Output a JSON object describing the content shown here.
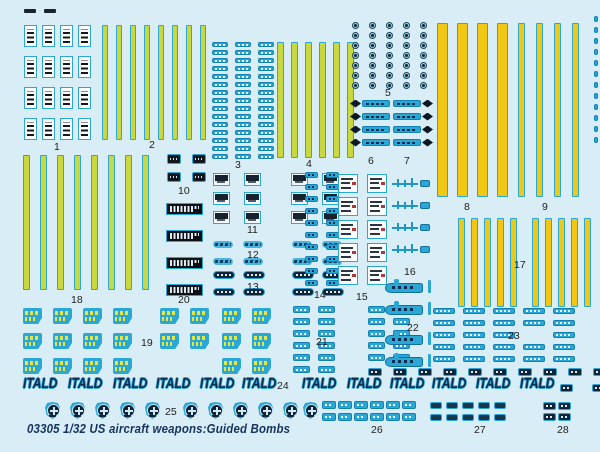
{
  "sheet": {
    "width": 600,
    "height": 452
  },
  "caption": {
    "text": "03305 1/32 US aircraft weapons:Guided Bombs",
    "color": "#14335e"
  },
  "palette": {
    "background": "#d9edf6",
    "teal": "#2ba7d6",
    "teal_dark": "#1181b4",
    "navy": "#0e2a4c",
    "black": "#10161c",
    "stripe_green": "#c9d83e",
    "stripe_gold": "#f0c713",
    "stencil_yellow": "#e9e53f",
    "red_mark": "#b33636",
    "white": "#ffffff"
  },
  "itald": {
    "text": "ITALD",
    "y": 375,
    "xs": [
      23,
      68,
      113,
      156,
      200,
      242,
      302,
      347,
      390,
      432,
      476,
      520
    ]
  },
  "roundels": {
    "y": 402,
    "w": 15,
    "h": 17,
    "xs": [
      45,
      70,
      95,
      120,
      145,
      183,
      208,
      233,
      258,
      283,
      303
    ]
  },
  "labels": [
    {
      "text": "1",
      "x": 54,
      "y": 141
    },
    {
      "text": "2",
      "x": 149,
      "y": 139
    },
    {
      "text": "3",
      "x": 235,
      "y": 159
    },
    {
      "text": "4",
      "x": 306,
      "y": 158
    },
    {
      "text": "5",
      "x": 385,
      "y": 87
    },
    {
      "text": "6",
      "x": 368,
      "y": 155
    },
    {
      "text": "7",
      "x": 404,
      "y": 155
    },
    {
      "text": "8",
      "x": 464,
      "y": 201
    },
    {
      "text": "9",
      "x": 542,
      "y": 201
    },
    {
      "text": "10",
      "x": 178,
      "y": 185
    },
    {
      "text": "11",
      "x": 247,
      "y": 224
    },
    {
      "text": "12",
      "x": 247,
      "y": 249
    },
    {
      "text": "13",
      "x": 247,
      "y": 281
    },
    {
      "text": "14",
      "x": 314,
      "y": 289
    },
    {
      "text": "15",
      "x": 356,
      "y": 291
    },
    {
      "text": "16",
      "x": 404,
      "y": 266
    },
    {
      "text": "17",
      "x": 514,
      "y": 259
    },
    {
      "text": "18",
      "x": 71,
      "y": 294
    },
    {
      "text": "19",
      "x": 141,
      "y": 337
    },
    {
      "text": "20",
      "x": 178,
      "y": 294
    },
    {
      "text": "21",
      "x": 316,
      "y": 336
    },
    {
      "text": "22",
      "x": 407,
      "y": 322
    },
    {
      "text": "23",
      "x": 508,
      "y": 330
    },
    {
      "text": "24",
      "x": 277,
      "y": 380
    },
    {
      "text": "25",
      "x": 165,
      "y": 406
    },
    {
      "text": "26",
      "x": 371,
      "y": 424
    },
    {
      "text": "27",
      "x": 474,
      "y": 424
    },
    {
      "text": "28",
      "x": 557,
      "y": 424
    }
  ],
  "groups": [
    {
      "name": "corner-fragments",
      "kind": "grid",
      "cls": "dash d-frag",
      "x": 24,
      "y": 9,
      "cols": 2,
      "rows": 1,
      "w": 12,
      "h": 4,
      "gx": 8,
      "gy": 0
    },
    {
      "name": "group-1-stencil-stamps",
      "kind": "grid",
      "cls": "stamp",
      "x": 24,
      "y": 25,
      "cols": 4,
      "rows": 4,
      "w": 13,
      "h": 22,
      "gx": 5,
      "gy": 9
    },
    {
      "name": "group-2-stripes",
      "kind": "stripes",
      "fill": "green",
      "x": 102,
      "y": 25,
      "count": 8,
      "sw": 6,
      "gap": 8,
      "h": 115
    },
    {
      "name": "group-3-dash-columns",
      "kind": "grid",
      "cls": "dash d-tt",
      "x": 212,
      "y": 42,
      "cols": 3,
      "rows": 15,
      "w": 16,
      "h": 5,
      "gx": 7,
      "gy": 3
    },
    {
      "name": "group-4-stripes",
      "kind": "stripes",
      "fill": "green",
      "x": 277,
      "y": 42,
      "count": 6,
      "sw": 7,
      "gap": 7,
      "h": 116
    },
    {
      "name": "group-5-circle-grid",
      "kind": "grid",
      "cls": "circ",
      "x": 352,
      "y": 22,
      "cols": 5,
      "rows": 7,
      "w": 7,
      "h": 7,
      "gx": 10,
      "gy": 3
    },
    {
      "name": "group-6-arrows",
      "kind": "arrows",
      "dir": "left",
      "x": 350,
      "y": 99,
      "rows": 4,
      "w": 40,
      "h": 9,
      "gy": 4
    },
    {
      "name": "group-7-arrows",
      "kind": "arrows",
      "dir": "right",
      "x": 393,
      "y": 99,
      "rows": 4,
      "w": 40,
      "h": 9,
      "gy": 4
    },
    {
      "name": "group-8-stripes",
      "kind": "stripes",
      "fill": "gold",
      "x": 437,
      "y": 23,
      "count": 4,
      "sw": 11,
      "gap": 9,
      "h": 174
    },
    {
      "name": "group-9-stripes",
      "kind": "stripes",
      "fill": "gold",
      "x": 518,
      "y": 23,
      "count": 4,
      "sw": 7,
      "gap": 11,
      "h": 174
    },
    {
      "name": "edge-dash-line",
      "kind": "grid",
      "cls": "dash d-tp",
      "x": 594,
      "y": 16,
      "cols": 1,
      "rows": 12,
      "w": 4,
      "h": 6,
      "gx": 0,
      "gy": 5
    },
    {
      "name": "group-10-black-squares",
      "kind": "grid",
      "cls": "dash d-bs",
      "x": 167,
      "y": 154,
      "cols": 2,
      "rows": 2,
      "w": 14,
      "h": 10,
      "gx": 11,
      "gy": 8
    },
    {
      "name": "group-11-gauges-left",
      "kind": "grid",
      "cls": "gauge",
      "x": 213,
      "y": 173,
      "cols": 2,
      "rows": 3,
      "w": 17,
      "h": 13,
      "gx": 14,
      "gy": 6
    },
    {
      "name": "group-11-gauges-right",
      "kind": "grid",
      "cls": "gauge",
      "x": 291,
      "y": 173,
      "cols": 2,
      "rows": 3,
      "w": 17,
      "h": 13,
      "gx": 14,
      "gy": 6
    },
    {
      "name": "group-12-script-left",
      "kind": "grid",
      "cls": "scriptm",
      "x": 213,
      "y": 241,
      "cols": 2,
      "rows": 2,
      "w": 20,
      "h": 7,
      "gx": 10,
      "gy": 10
    },
    {
      "name": "group-12-script-right",
      "kind": "grid",
      "cls": "scriptm",
      "x": 292,
      "y": 241,
      "cols": 2,
      "rows": 2,
      "w": 20,
      "h": 7,
      "gx": 10,
      "gy": 10
    },
    {
      "name": "group-13-pills-left",
      "kind": "grid",
      "cls": "pill",
      "x": 213,
      "y": 271,
      "cols": 2,
      "rows": 2,
      "w": 22,
      "h": 8,
      "gx": 8,
      "gy": 9
    },
    {
      "name": "group-13-pills-right",
      "kind": "grid",
      "cls": "pill",
      "x": 292,
      "y": 271,
      "cols": 2,
      "rows": 2,
      "w": 22,
      "h": 8,
      "gx": 8,
      "gy": 9
    },
    {
      "name": "group-14-dash-columns",
      "kind": "grid",
      "cls": "dash d-td",
      "x": 305,
      "y": 172,
      "cols": 2,
      "rows": 10,
      "w": 13,
      "h": 6,
      "gx": 8,
      "gy": 6
    },
    {
      "name": "group-15-white-squares",
      "kind": "grid",
      "cls": "wsq",
      "x": 338,
      "y": 174,
      "cols": 2,
      "rows": 5,
      "w": 20,
      "h": 19,
      "gx": 9,
      "gy": 4
    },
    {
      "name": "group-16-decoy-shapes",
      "kind": "missiles",
      "x": 392,
      "ys": [
        176,
        198,
        220,
        242
      ],
      "w": 38,
      "h": 12
    },
    {
      "name": "group-17-stripes-left",
      "kind": "stripes",
      "fill": "gold",
      "x": 458,
      "y": 218,
      "count": 5,
      "sw": 7,
      "gap": 6,
      "h": 89
    },
    {
      "name": "group-17-stripes-right",
      "kind": "stripes",
      "fill": "gold",
      "x": 532,
      "y": 218,
      "count": 5,
      "sw": 7,
      "gap": 6,
      "h": 89
    },
    {
      "name": "group-18-stripes",
      "kind": "stripes",
      "fill": "green",
      "x": 23,
      "y": 155,
      "count": 8,
      "sw": 7,
      "gap": 10,
      "h": 135
    },
    {
      "name": "group-19-yellow-stencils",
      "kind": "grid",
      "cls": "stencil",
      "colXs": [
        23,
        53,
        83,
        113,
        160,
        190,
        222,
        252
      ],
      "y": 308,
      "rows": 3,
      "w": 19,
      "h": 16,
      "gy": 9,
      "skip": [
        [
          4,
          2
        ],
        [
          5,
          2
        ]
      ]
    },
    {
      "name": "group-20-data-plates",
      "kind": "grid",
      "cls": "plate",
      "x": 166,
      "y": 203,
      "cols": 1,
      "rows": 4,
      "w": 37,
      "h": 12,
      "gx": 0,
      "gy": 15
    },
    {
      "name": "group-21-dashes-left",
      "kind": "grid",
      "cls": "dash d-tt",
      "x": 293,
      "y": 306,
      "cols": 2,
      "rows": 6,
      "w": 17,
      "h": 7,
      "gx": 8,
      "gy": 5
    },
    {
      "name": "group-21-dashes-right",
      "kind": "grid",
      "cls": "dash d-tt",
      "x": 368,
      "y": 306,
      "cols": 2,
      "rows": 5,
      "w": 17,
      "h": 7,
      "gx": 8,
      "gy": 5
    },
    {
      "name": "group-22-whale-shapes",
      "kind": "whales",
      "x": 385,
      "ys": [
        279,
        301,
        331,
        353
      ],
      "w": 46,
      "h": 16
    },
    {
      "name": "group-23-strips",
      "kind": "grid",
      "cls": "dash d-tt",
      "x": 433,
      "y": 308,
      "cols": 5,
      "rows": 5,
      "w": 22,
      "h": 6,
      "gx": 8,
      "gy": 6,
      "skip": [
        [
          3,
          2
        ]
      ]
    },
    {
      "name": "dark-dash-row",
      "kind": "grid",
      "cls": "dash d-dt",
      "x": 368,
      "y": 368,
      "cols": 10,
      "rows": 1,
      "w": 14,
      "h": 8,
      "gx": 11,
      "gy": 0
    },
    {
      "name": "itald-row-end-dashes",
      "kind": "grid",
      "cls": "dash d-dt",
      "x": 560,
      "y": 384,
      "cols": 2,
      "rows": 1,
      "w": 13,
      "h": 8,
      "gx": 19,
      "gy": 0
    },
    {
      "name": "group-26-dashes",
      "kind": "grid",
      "cls": "dash d-tt",
      "x": 322,
      "y": 401,
      "cols": 6,
      "rows": 2,
      "w": 14,
      "h": 8,
      "gx": 2,
      "gy": 4
    },
    {
      "name": "group-27-dashes",
      "kind": "grid",
      "cls": "dash d-dp",
      "x": 430,
      "y": 402,
      "cols": 5,
      "rows": 2,
      "w": 12,
      "h": 7,
      "gx": 4,
      "gy": 5
    },
    {
      "name": "group-28-dashes",
      "kind": "grid",
      "cls": "dash d-dt",
      "x": 543,
      "y": 402,
      "cols": 2,
      "rows": 2,
      "w": 13,
      "h": 8,
      "gx": 2,
      "gy": 3
    }
  ]
}
